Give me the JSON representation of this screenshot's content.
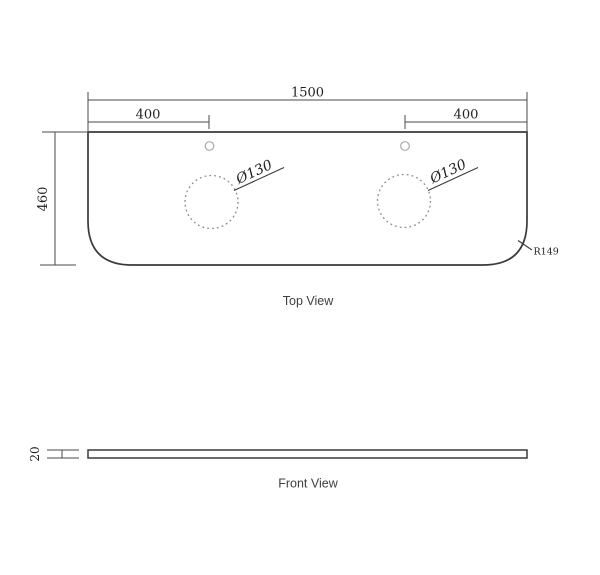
{
  "colors": {
    "background": "#ffffff",
    "outline": "#3a3a3a",
    "dimension_line": "#4a4a4a",
    "dimension_text": "#1f1f1f",
    "dashed_circle": "#8a8a8a",
    "faucet_hole": "#a9a9a9",
    "view_label": "#3f3f3f"
  },
  "top_view": {
    "label": "Top View",
    "dimensions": {
      "overall_width": "1500",
      "left_hole_offset": "400",
      "right_hole_offset": "400",
      "overall_depth": "460",
      "left_basin_diameter": "Ø130",
      "right_basin_diameter": "Ø130",
      "corner_radius": "R149"
    }
  },
  "front_view": {
    "label": "Front View",
    "dimensions": {
      "thickness": "20"
    }
  }
}
